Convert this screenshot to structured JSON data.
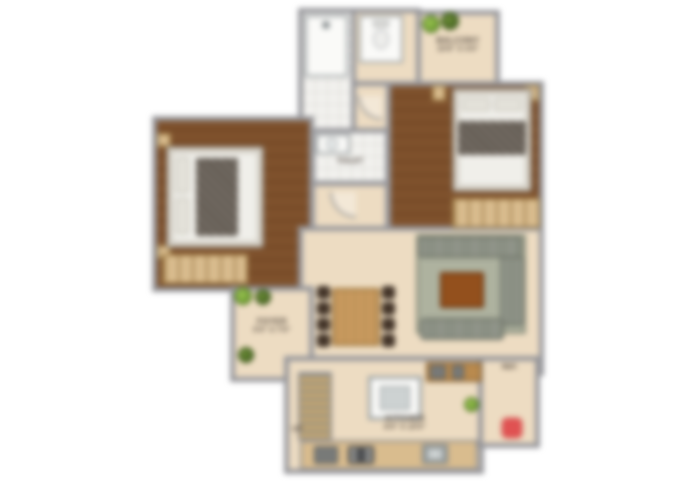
{
  "page": {
    "background": "#ffffff",
    "description": "Blurred 2BHK apartment floor plan rendering, top-down view"
  },
  "colors": {
    "wall": "#97979b",
    "wood_floor": "#7b4c26",
    "beige_floor": "#eddcc2",
    "tile_floor": "#f3f2ef",
    "wardrobe_tan": "#d9bc8e",
    "sofa_gray": "#8b9084",
    "rug_sage": "#aeb29f",
    "coffee_table_brown": "#93501d",
    "dining_wood": "#c89a5e",
    "plant_green": "#6a9a2e",
    "accent_red": "#e05252"
  },
  "rooms": {
    "balcony": {
      "line1": "BALCONY",
      "line2": "10'6\" X 4'0\""
    },
    "toilet": {
      "line1": "TOILET"
    },
    "foyer": {
      "line1": "FOYER",
      "line2": "5'0\" X 7'0\""
    },
    "kitchen": {
      "line1": "KITCHEN",
      "line2": "8'0\" X 10'0\""
    },
    "utility": {
      "line1": "REF."
    },
    "stairs": {
      "line1": "UP"
    }
  },
  "furniture_icons": [
    "double-bed",
    "wardrobe",
    "nightstand",
    "dining-table",
    "dining-chair",
    "sofa-sectional",
    "coffee-table",
    "rug",
    "shower",
    "toilet-wc",
    "wash-basin",
    "kitchen-island",
    "cooktop",
    "gas-hob",
    "kitchen-sink",
    "counter",
    "staircase-shelf",
    "plant",
    "brand-logo"
  ]
}
